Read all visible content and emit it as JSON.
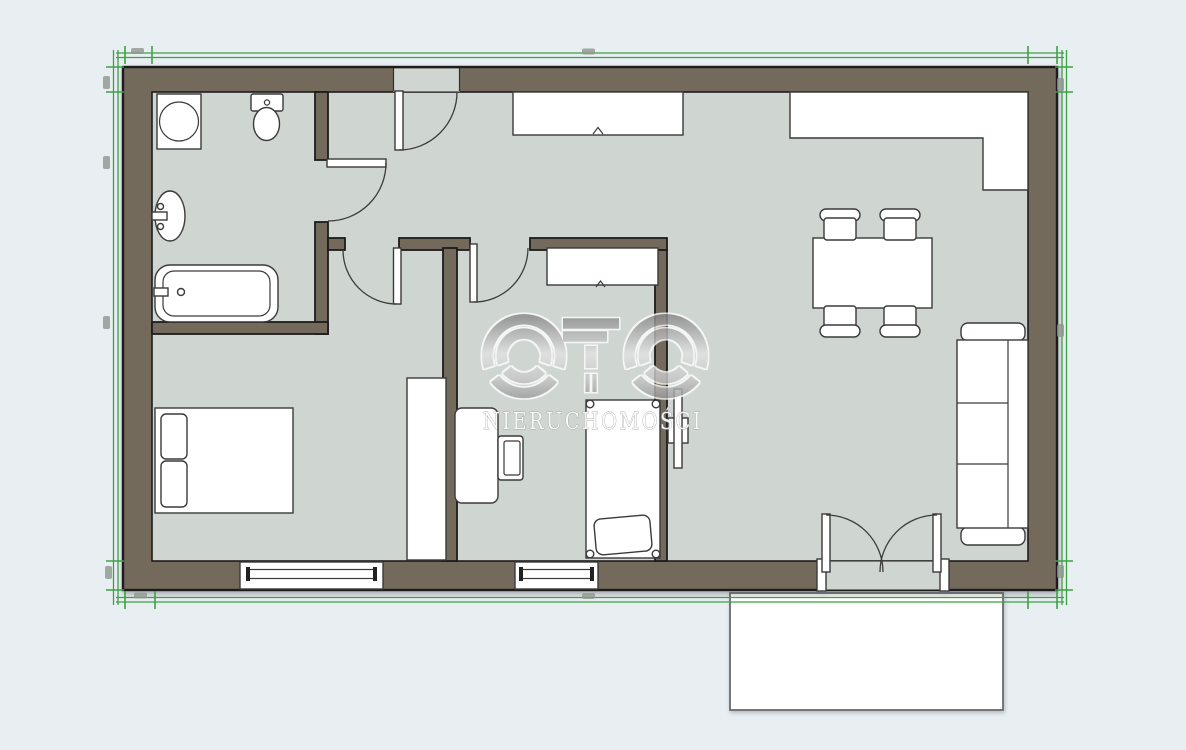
{
  "watermark": {
    "logo_text": "OTO",
    "subtitle": "NIERUCHOMOŚCI"
  },
  "colors": {
    "bg": "#e9eef2",
    "floor": "#cfd6d2",
    "wall": "#746a5c",
    "ink": "#1c1c1c",
    "line": "#3a3a3a",
    "white": "#ffffff",
    "green": "#3da244",
    "blob": "#8f968f",
    "wm_light": "#e2e2e2",
    "wm_dark": "#8b8b8b",
    "wm_text": "#fbfbfb"
  },
  "rooms": {
    "bathroom": {
      "fixtures": [
        "washing-machine-icon",
        "toilet-icon",
        "washbasin-icon",
        "bathtub-icon"
      ]
    },
    "bedroom": {
      "fixtures": [
        "double-bed-icon",
        "wardrobe-icon",
        "window-icon"
      ]
    },
    "office": {
      "fixtures": [
        "wardrobe-icon",
        "desk-icon",
        "chair-icon",
        "single-bed-icon",
        "window-icon"
      ]
    },
    "living_kitchen": {
      "fixtures": [
        "sideboard-icon",
        "kitchen-counter-icon",
        "dining-table-icon",
        "dining-chair-icon",
        "sofa-icon",
        "tv-icon",
        "french-door-icon"
      ]
    },
    "outside": {
      "fixtures": [
        "terrace-icon"
      ]
    }
  }
}
